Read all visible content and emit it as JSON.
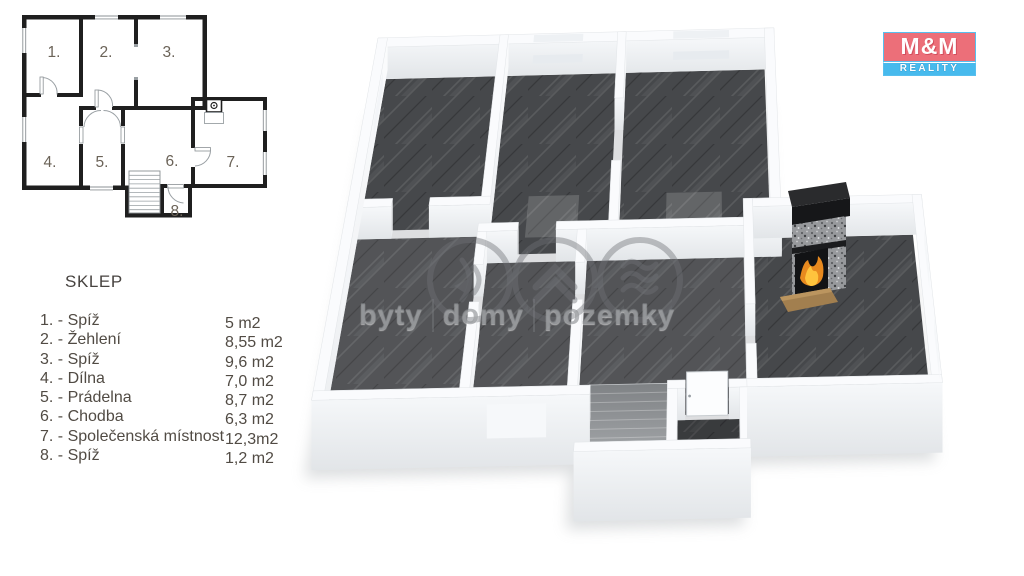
{
  "legend": {
    "title": "SKLEP",
    "rooms": [
      {
        "label": "1. - Spíž",
        "area": "5 m2"
      },
      {
        "label": "2. - Žehlení",
        "area": "8,55 m2"
      },
      {
        "label": "3. - Spíž",
        "area": "9,6 m2"
      },
      {
        "label": "4. - Dílna",
        "area": "7,0 m2"
      },
      {
        "label": "5. - Prádelna",
        "area": "8,7 m2"
      },
      {
        "label": "6. - Chodba",
        "area": "6,3 m2"
      },
      {
        "label": "7. - Společenská místnost",
        "area": "12,3m2"
      },
      {
        "label": "8. - Spíž",
        "area": "1,2 m2"
      }
    ]
  },
  "plan": {
    "room_labels": [
      "1.",
      "2.",
      "3.",
      "4.",
      "5.",
      "6.",
      "7.",
      "8."
    ]
  },
  "logo": {
    "top": "M&M",
    "bottom": "REALITY",
    "red": "#ec6f79",
    "blue": "#47baed"
  },
  "watermark": {
    "words": [
      "byty",
      "domy",
      "pozemky"
    ]
  },
  "colors": {
    "floor_dark": "#46484b",
    "wall_white": "#fafbfd",
    "plan_wall_black": "#1f1f1f",
    "legend_text": "#514b44",
    "plan_label": "#6b6358",
    "hearth_brown": "#a27f4f"
  }
}
